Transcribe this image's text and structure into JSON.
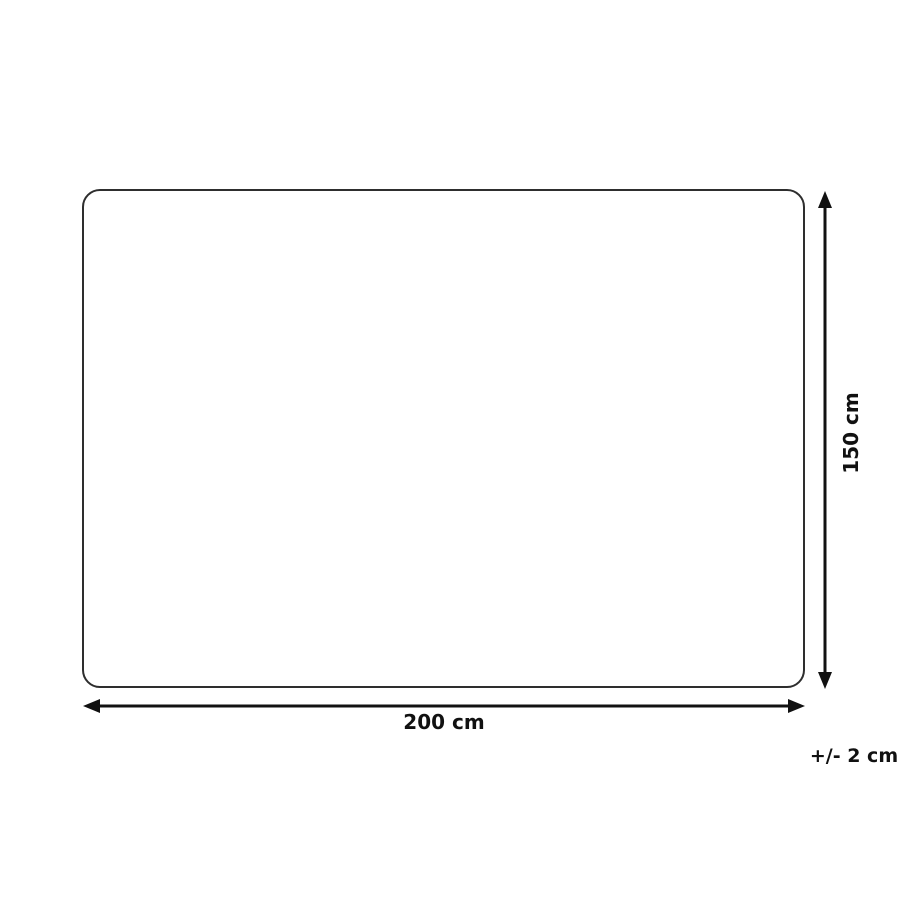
{
  "diagram": {
    "type": "product-dimension-diagram",
    "shape": "rounded-rectangle",
    "width_label": "200 cm",
    "height_label": "150 cm",
    "tolerance_label": "+/- 2 cm",
    "colors": {
      "outline": "#2e2e2e",
      "arrow": "#111111",
      "text": "#111111",
      "background": "#ffffff"
    }
  }
}
